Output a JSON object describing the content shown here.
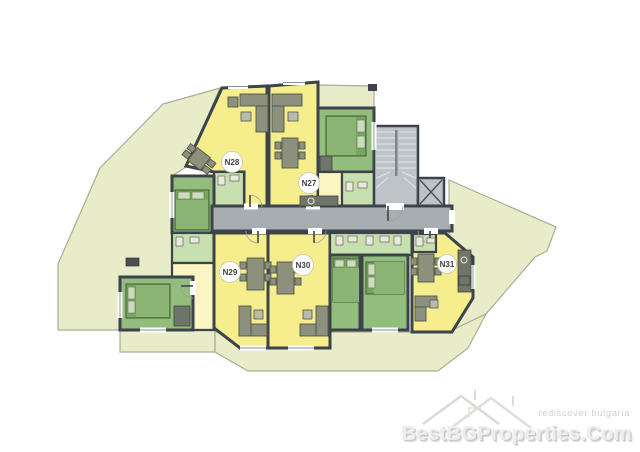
{
  "plan": {
    "units": [
      {
        "id": "n28",
        "label": "N28"
      },
      {
        "id": "n27",
        "label": "N27"
      },
      {
        "id": "n29",
        "label": "N29"
      },
      {
        "id": "n30",
        "label": "N30"
      },
      {
        "id": "n31",
        "label": "N31"
      }
    ],
    "icons": {
      "staircase": "staircase-icon",
      "elevator": "elevator-icon"
    }
  },
  "watermark": {
    "logo_icon": "roofs-logo-icon",
    "slogan": "rediscover bulgaria",
    "site": "BestBGProperties.Com"
  },
  "colors": {
    "wall": "#3c434a",
    "living": "#f6ee8d",
    "hall": "#faf5c2",
    "bedroom": "#93bd7d",
    "bath": "#c8dfb0",
    "terrace": "#e9ecc8",
    "terrace_edge": "#aaac94",
    "corridor": "#a7aeb2",
    "stairs": "#bdc3c7",
    "furniture": "#8d907c",
    "furniture_dark": "#51554a",
    "bed": "#78a55f",
    "bed_light": "#8bb475",
    "pillow": "#cddcbd",
    "label_text": "#3f4145",
    "watermark_light": "#ededeb",
    "watermark_shadow": "#c9c9c6"
  }
}
